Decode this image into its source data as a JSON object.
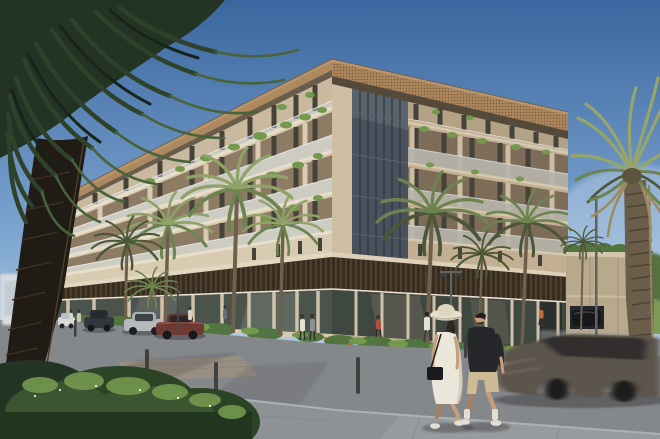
{
  "scene": {
    "description": "Daytime architectural rendering: cream low-rise apartment building with balconies and a dark louvered podium, street palms, parked cars, a walking couple, and a motion-blurred passing car",
    "text_content": "none"
  },
  "palette": {
    "sky_top": "#3a669f",
    "sky_mid": "#7fa7d1",
    "sky_horizon": "#c9dbe9",
    "haze": "#e8eef4",
    "facade_light": "#d9cbb1",
    "facade_shadow": "#c3b092",
    "facade_far": "#cdbfa6",
    "recess_left": "#8d7b63",
    "recess_right": "#7d6c57",
    "window_glass": "#45423a",
    "slab_light": "#e8decа",
    "slab_light_fix": "#e8deca",
    "slab_right": "#d6c8ae",
    "rail_light": "#c2ced6",
    "rail_shadow": "#9fadb8",
    "roof_copper": "#c09464",
    "roof_fascia": "#ab855c",
    "roof_soffit": "#55493a",
    "corner_glass": "#49525c",
    "louver_dark": "#362c1f",
    "louver_light": "#5e4c35",
    "storefront_left": "#4b534d",
    "storefront_right": "#3f4741",
    "storefront_pier": "#cec2aa",
    "canopy_dark": "#243424",
    "canopy_mid": "#2e4229",
    "canopy_lit": "#48633a",
    "palm_lit": "#8fa268",
    "palm_mid": "#6d8450",
    "palm_deep": "#4c5738",
    "palm_dried": "#a08b60",
    "palm_f_lit": "#97a56a",
    "trunk_silhouette": "#201b14",
    "trunk_texture": "#3a2f20",
    "trunk_right": "#6a5d4a",
    "trunk_ring": "#4e4436",
    "street_trunk": "#6f604b",
    "plant_dark": "#3a5530",
    "plant_mid": "#527440",
    "plant_light": "#74984e",
    "flower_orange": "#c4703c",
    "flower_white": "#e8ecdf",
    "bed_curb": "#d7d3c9",
    "road": "#85888b",
    "road_light": "#9aa0a2",
    "pavement": "#8f9295",
    "pavement_light": "#9ea1a4",
    "paver_tan": "#9b9180",
    "curb_edge": "#aeb1b3",
    "shadow": "#26282a",
    "annex_wall": "#b8a88c",
    "annex_parapet": "#d3c6ad",
    "bg_building": "#d5dbe1",
    "bg_tree": "#55713f",
    "grass": "#7d9a58",
    "lamp_pole": "#62625e",
    "bollard": "#3f403e",
    "car_white": "#d9dad8",
    "car_dark": "#33373b",
    "car_silver": "#b6babc",
    "car_maroon": "#6e3a33",
    "car_moving": "#5b554b",
    "car_glass": "#272a2c",
    "suv_dark": "#15181b",
    "skin": "#c79e7c",
    "skin_shadow": "#a87f60",
    "dress_white": "#ece7db",
    "hat_cream": "#e7dfcb",
    "bag_black": "#1b1b1d",
    "shirt_black": "#26272b",
    "shorts_tan": "#cdbb95",
    "shoe_white": "#e2ded2",
    "ped_white": "#e4e0d6",
    "ped_grey": "#8c8f94",
    "ped_red": "#b0513f",
    "ped_orange": "#c2693a"
  }
}
